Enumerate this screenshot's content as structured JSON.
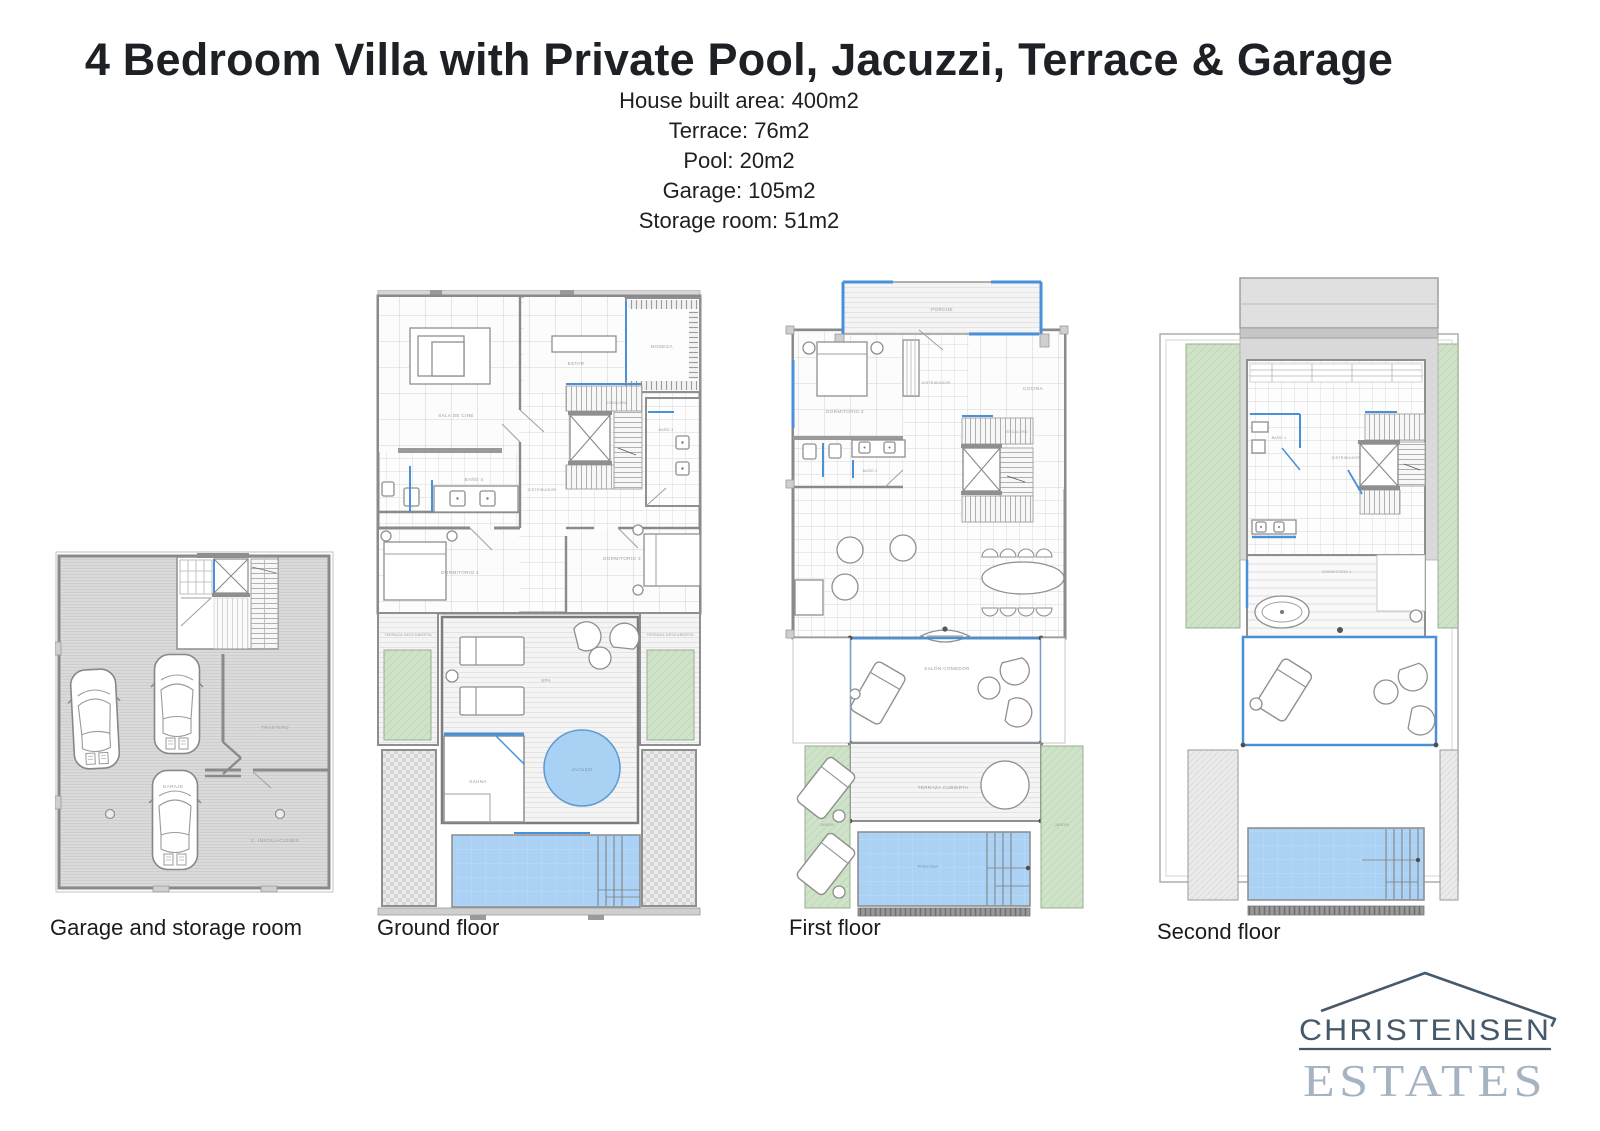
{
  "header": {
    "title": "4 Bedroom Villa with Private Pool, Jacuzzi, Terrace & Garage",
    "specs": [
      "House built area: 400m2",
      "Terrace: 76m2",
      "Pool: 20m2",
      "Garage: 105m2",
      "Storage room: 51m2"
    ]
  },
  "plans": {
    "garage": {
      "caption": "Garage and storage room",
      "rooms": {
        "garaje": "GARAJE",
        "trastero": "TRASTERO",
        "instalaciones": "C. INSTALACIONES"
      }
    },
    "ground": {
      "caption": "Ground floor",
      "rooms": {
        "sala_cine": "SALA DE CINE",
        "estar": "ESTAR",
        "bodega": "BODEGA",
        "escalera": "ESCALERA",
        "distribuidor": "DISTRIBUIDOR",
        "bano3": "BAÑO 3",
        "bano4": "BAÑO 4",
        "dormitorio3": "DORMITORIO 3",
        "dormitorio4": "DORMITORIO 4",
        "terraza_izq": "TERRAZA DESCUBIERTA",
        "terraza_der": "TERRAZA DESCUBIERTA",
        "spa": "SPA",
        "sauna": "SAUNA",
        "jacuzzi": "JACUZZI"
      }
    },
    "first": {
      "caption": "First floor",
      "rooms": {
        "porche": "PORCHE",
        "dormitorio2": "DORMITORIO 2",
        "distribuidor": "DISTRIBUIDOR",
        "cocina": "COCINA",
        "escalera": "ESCALERA",
        "bano2": "BAÑO 2",
        "salon": "SALÓN COMEDOR",
        "terraza": "TERRAZA CUBIERTA",
        "jardin_izq": "JARDÍN",
        "jardin_der": "JARDÍN",
        "piscina": "PISCINA"
      }
    },
    "second": {
      "caption": "Second floor",
      "rooms": {
        "bano1": "BAÑO 1",
        "distribuidor": "DISTRIBUIDOR",
        "dormitorio1": "DORMITORIO 1"
      }
    }
  },
  "logo": {
    "name": "CHRISTENSEN",
    "type": "ESTATES"
  },
  "colors": {
    "accent_blue": "#4a90d8",
    "pool_fill": "#abd2f5",
    "garden_green": "#cfe3c9",
    "wall_grey": "#8a8a8a",
    "logo_dark": "#46596a",
    "logo_light": "#a6b3c2"
  }
}
